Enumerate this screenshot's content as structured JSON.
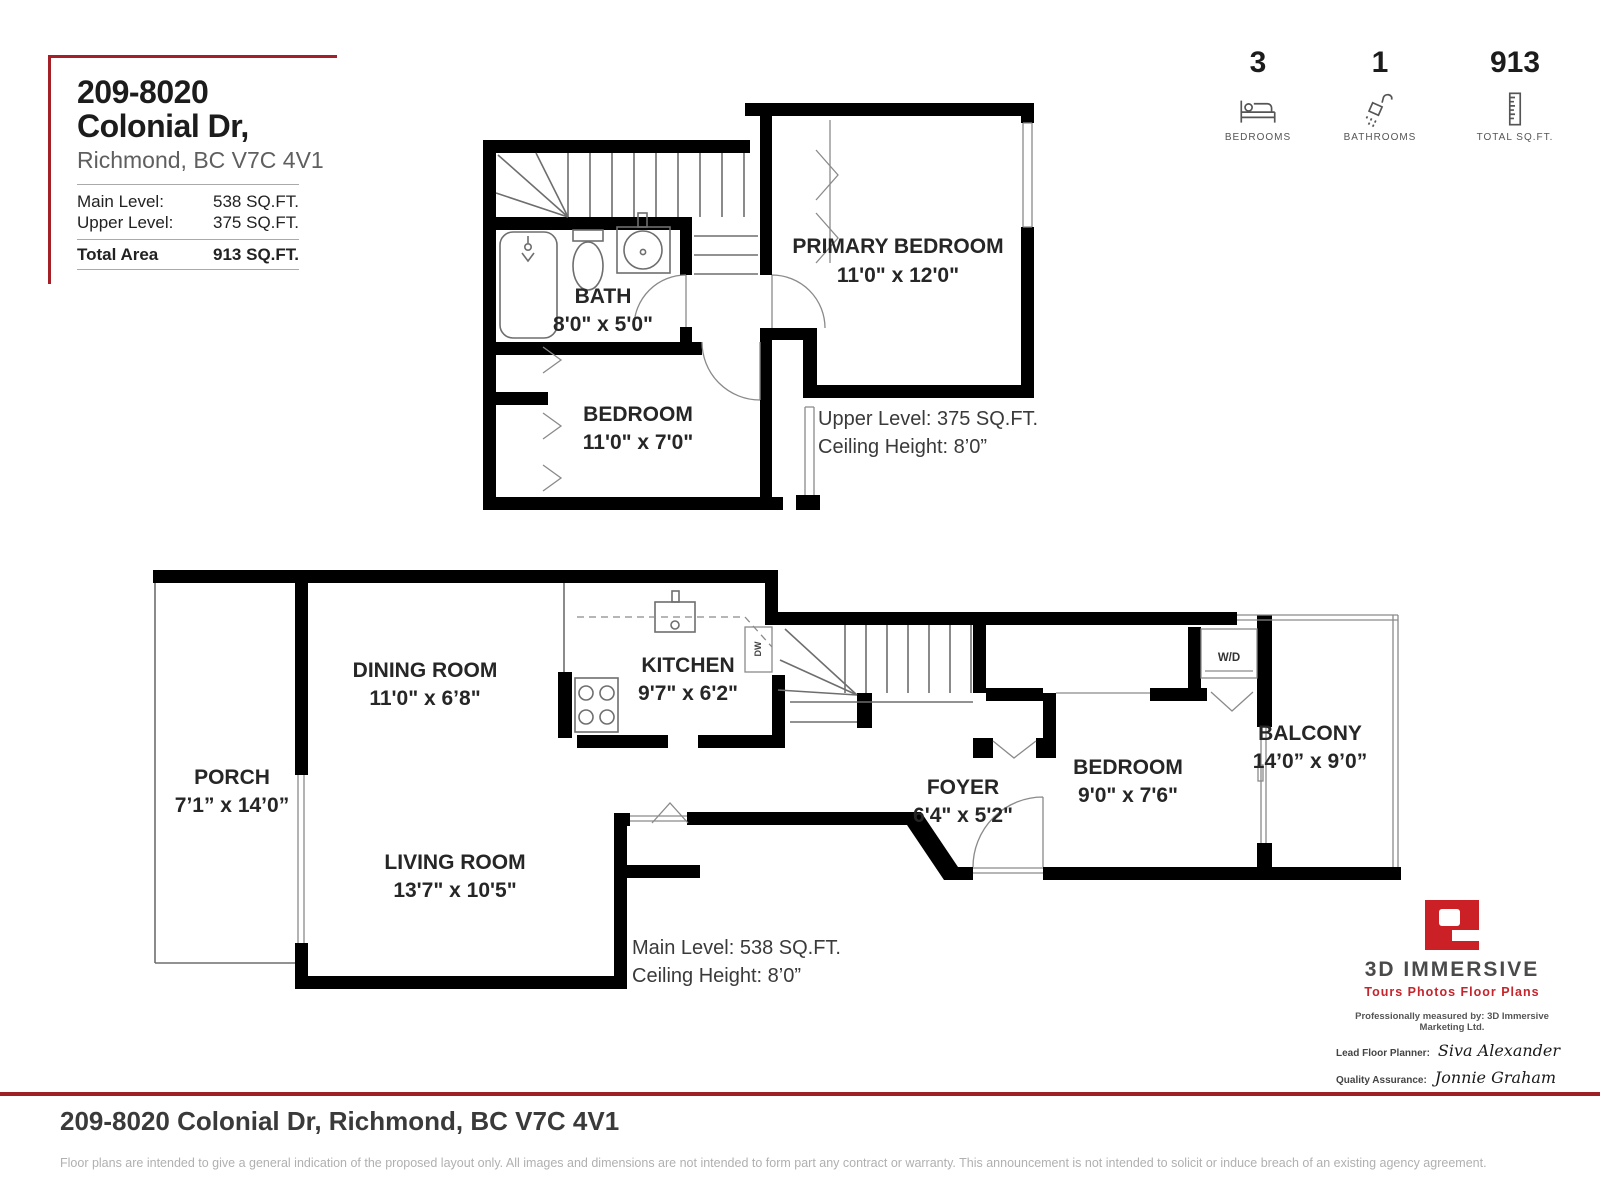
{
  "header": {
    "title": "209-8020 Colonial Dr,",
    "subtitle": "Richmond, BC V7C 4V1",
    "rows": [
      {
        "label": "Main Level:",
        "value": "538 SQ.FT."
      },
      {
        "label": "Upper Level:",
        "value": "375 SQ.FT."
      }
    ],
    "total": {
      "label": "Total Area",
      "value": "913 SQ.FT."
    }
  },
  "stats": [
    {
      "value": "3",
      "label": "BEDROOMS",
      "icon": "bed-icon"
    },
    {
      "value": "1",
      "label": "BATHROOMS",
      "icon": "shower-icon"
    },
    {
      "value": "913",
      "label": "TOTAL SQ.FT.",
      "icon": "ruler-icon"
    }
  ],
  "upper_plan": {
    "rooms": [
      {
        "name": "PRIMARY BEDROOM",
        "dims": "11'0\" x 12'0\""
      },
      {
        "name": "BATH",
        "dims": "8'0\" x 5'0\""
      },
      {
        "name": "BEDROOM",
        "dims": "11'0\" x 7'0\""
      }
    ],
    "level_note": "Upper Level: 375 SQ.FT.",
    "ceiling_note": "Ceiling Height: 8’0”"
  },
  "main_plan": {
    "rooms": [
      {
        "name": "PORCH",
        "dims": "7’1” x 14’0”"
      },
      {
        "name": "DINING ROOM",
        "dims": "11'0\" x 6’8\""
      },
      {
        "name": "KITCHEN",
        "dims": "9'7\" x 6'2\""
      },
      {
        "name": "LIVING ROOM",
        "dims": "13'7\" x 10'5\""
      },
      {
        "name": "FOYER",
        "dims": "6'4\" x 5'2\""
      },
      {
        "name": "BEDROOM",
        "dims": "9'0\" x 7'6\""
      },
      {
        "name": "BALCONY",
        "dims": "14’0” x 9’0”"
      }
    ],
    "labels": {
      "wd": "W/D",
      "dw": "DW"
    },
    "level_note": "Main Level: 538 SQ.FT.",
    "ceiling_note": "Ceiling Height: 8’0”"
  },
  "branding": {
    "name": "3D IMMERSIVE",
    "tagline": "Tours  Photos  Floor Plans",
    "measured_by": "Professionally measured by: 3D Immersive Marketing Ltd.",
    "planner_label": "Lead Floor Planner:",
    "planner_name": "Siva Alexander",
    "qa_label": "Quality Assurance:",
    "qa_name": "Jonnie Graham"
  },
  "footer": {
    "address": "209-8020 Colonial Dr, Richmond, BC V7C 4V1",
    "disclaimer": "Floor plans are intended to give a general indication of the proposed layout only. All images and dimensions are not intended to form part any contract or warranty.  This announcement is not intended to solicit or induce breach of an existing agency agreement."
  },
  "colors": {
    "accent_red": "#a32026",
    "logo_red": "#cc2027",
    "wall_black": "#000000"
  }
}
